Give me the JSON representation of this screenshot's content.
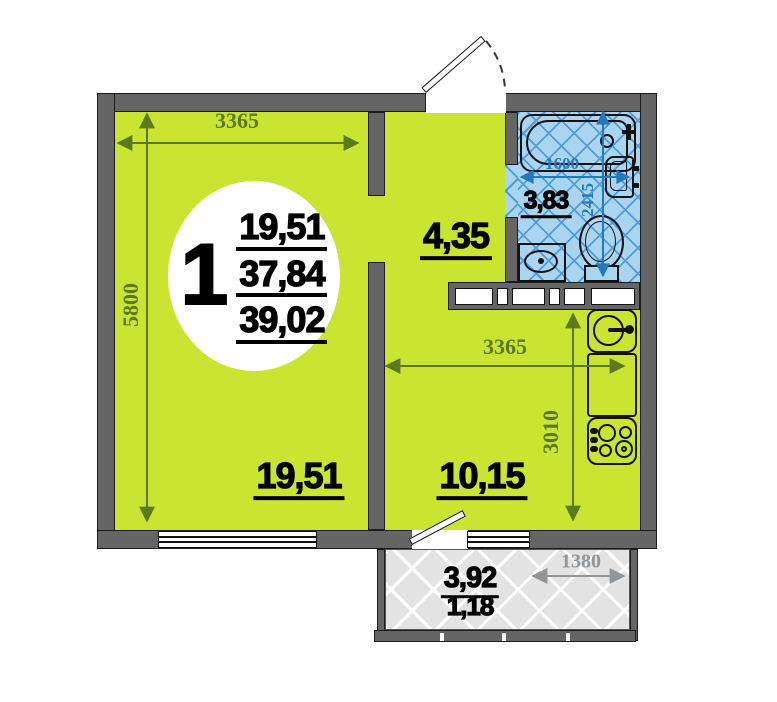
{
  "unit_circle": {
    "number": "1",
    "area_values": [
      "19,51",
      "37,84",
      "39,02"
    ]
  },
  "rooms": {
    "living": {
      "area": "19,51",
      "dim_width": "3365",
      "dim_height": "5800"
    },
    "hallway": {
      "area": "4,35"
    },
    "bathroom": {
      "area": "3,83",
      "dim_width": "1600",
      "dim_height": "2415"
    },
    "kitchen": {
      "area": "10,15",
      "dim_width": "3365",
      "dim_height": "3010"
    },
    "balcony": {
      "area": "3,92",
      "area_reduced": "1,18",
      "dim_width": "1380"
    }
  },
  "colors": {
    "floor_lime": "#c9e532",
    "wall_gray": "#666565",
    "bathroom_floor": "#a9d5f1",
    "bathroom_hatch": "#4f9cd8",
    "dim_green": "#5c7a1d",
    "dim_blue": "#2478bd",
    "dim_gray": "#8f9599",
    "balcony_floor": "#e3e3e3"
  }
}
